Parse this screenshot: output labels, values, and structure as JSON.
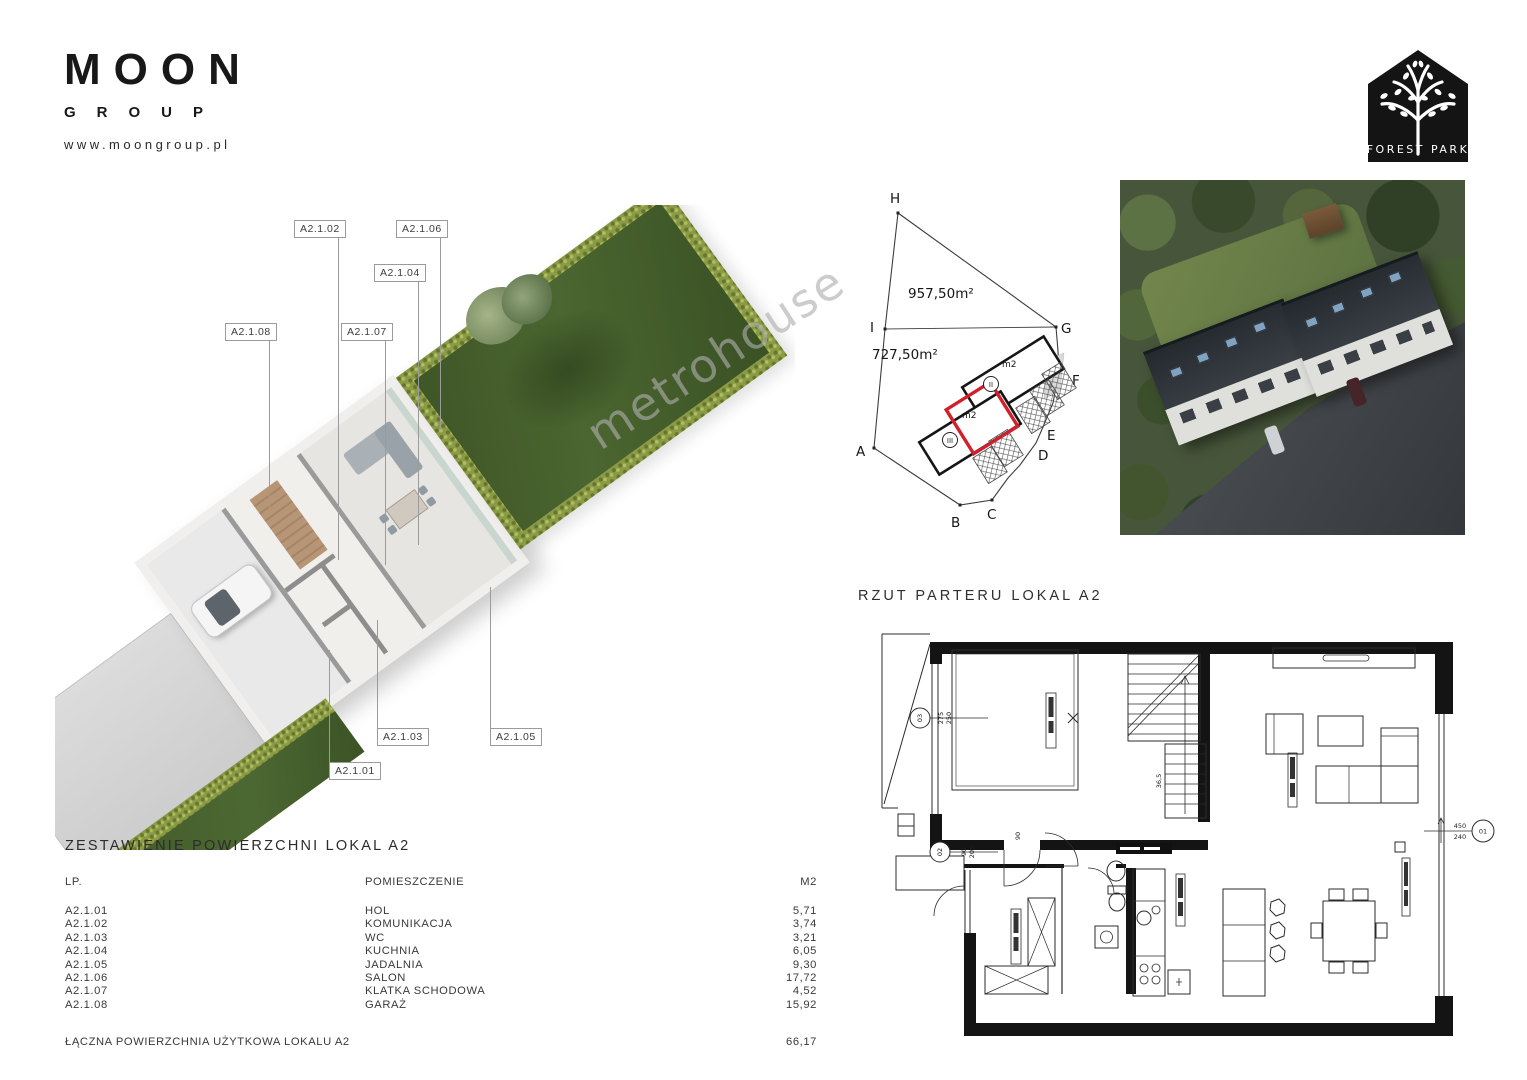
{
  "brand": {
    "name": "MOON",
    "sub": "GROUP",
    "website": "www.moongroup.pl"
  },
  "forest_park": {
    "label": "FOREST PARK"
  },
  "watermark": {
    "text": "metrohouse"
  },
  "callouts": [
    {
      "label": "A2.1.02"
    },
    {
      "label": "A2.1.06"
    },
    {
      "label": "A2.1.04"
    },
    {
      "label": "A2.1.08"
    },
    {
      "label": "A2.1.07"
    },
    {
      "label": "A2.1.03"
    },
    {
      "label": "A2.1.05"
    },
    {
      "label": "A2.1.01"
    }
  ],
  "site_plan": {
    "areas": {
      "upper": "957,50m²",
      "lower": "727,50m²"
    },
    "corners": {
      "a": "A",
      "b": "B",
      "c": "C",
      "d": "D",
      "e": "E",
      "f": "F",
      "g": "G",
      "h": "H",
      "i": "I"
    },
    "building_upper": {
      "marker": "m2",
      "number": "II"
    },
    "building_lower": {
      "marker": "m2",
      "number": "III"
    },
    "highlight_color": "#d21f2c"
  },
  "floor_plan": {
    "title": "RZUT PARTERU LOKAL A2",
    "markers": {
      "garage": {
        "id": "03",
        "dim_top": "275",
        "dim_bottom": "250"
      },
      "entry": {
        "id": "02",
        "dim_top": "90",
        "dim_bottom": "205"
      },
      "window": {
        "id": "01",
        "dim_top": "450",
        "dim_bottom": "240"
      }
    },
    "stairs_dim": "36,5",
    "door_dim": "90"
  },
  "summary_table": {
    "title": "ZESTAWIENIE POWIERZCHNI LOKAL A2",
    "columns": {
      "lp": "LP.",
      "room": "POMIESZCZENIE",
      "area": "M2"
    },
    "rows": [
      {
        "lp": "A2.1.01",
        "room": "HOL",
        "area": "5,71"
      },
      {
        "lp": "A2.1.02",
        "room": "KOMUNIKACJA",
        "area": "3,74"
      },
      {
        "lp": "A2.1.03",
        "room": "WC",
        "area": "3,21"
      },
      {
        "lp": "A2.1.04",
        "room": "KUCHNIA",
        "area": "6,05"
      },
      {
        "lp": "A2.1.05",
        "room": "JADALNIA",
        "area": "9,30"
      },
      {
        "lp": "A2.1.06",
        "room": "SALON",
        "area": "17,72"
      },
      {
        "lp": "A2.1.07",
        "room": "KLATKA SCHODOWA",
        "area": "4,52"
      },
      {
        "lp": "A2.1.08",
        "room": "GARAŻ",
        "area": "15,92"
      }
    ],
    "total": {
      "label": "ŁĄCZNA POWIERZCHNIA UŻYTKOWA LOKALU A2",
      "value": "66,17"
    }
  }
}
